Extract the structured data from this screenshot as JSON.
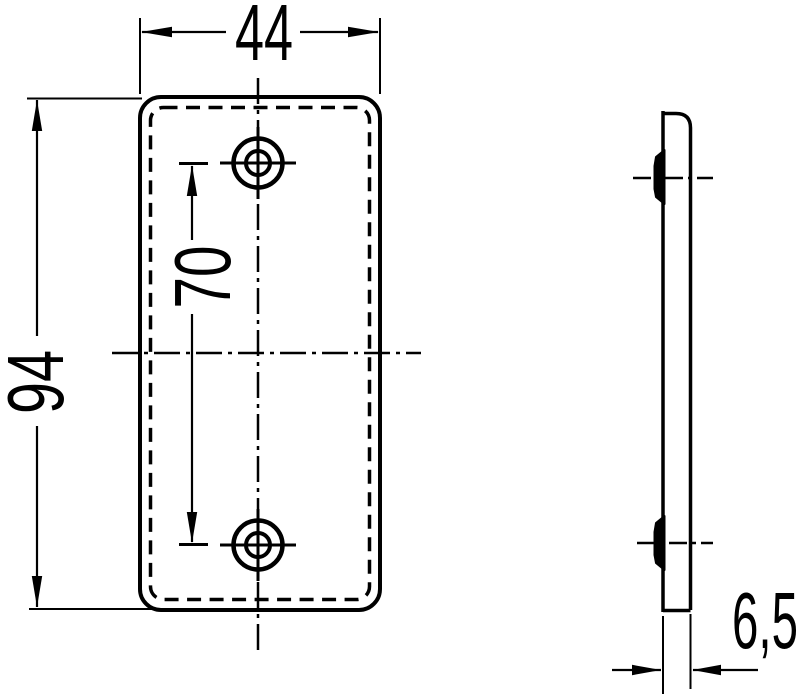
{
  "drawing": {
    "type": "technical-dimension-drawing",
    "colors": {
      "ink": "#000000",
      "paper": "#ffffff"
    },
    "front_view": {
      "width_label": "44",
      "height_label": "94",
      "hole_spacing_label": "70"
    },
    "side_view": {
      "thickness_label": "6,5"
    }
  }
}
